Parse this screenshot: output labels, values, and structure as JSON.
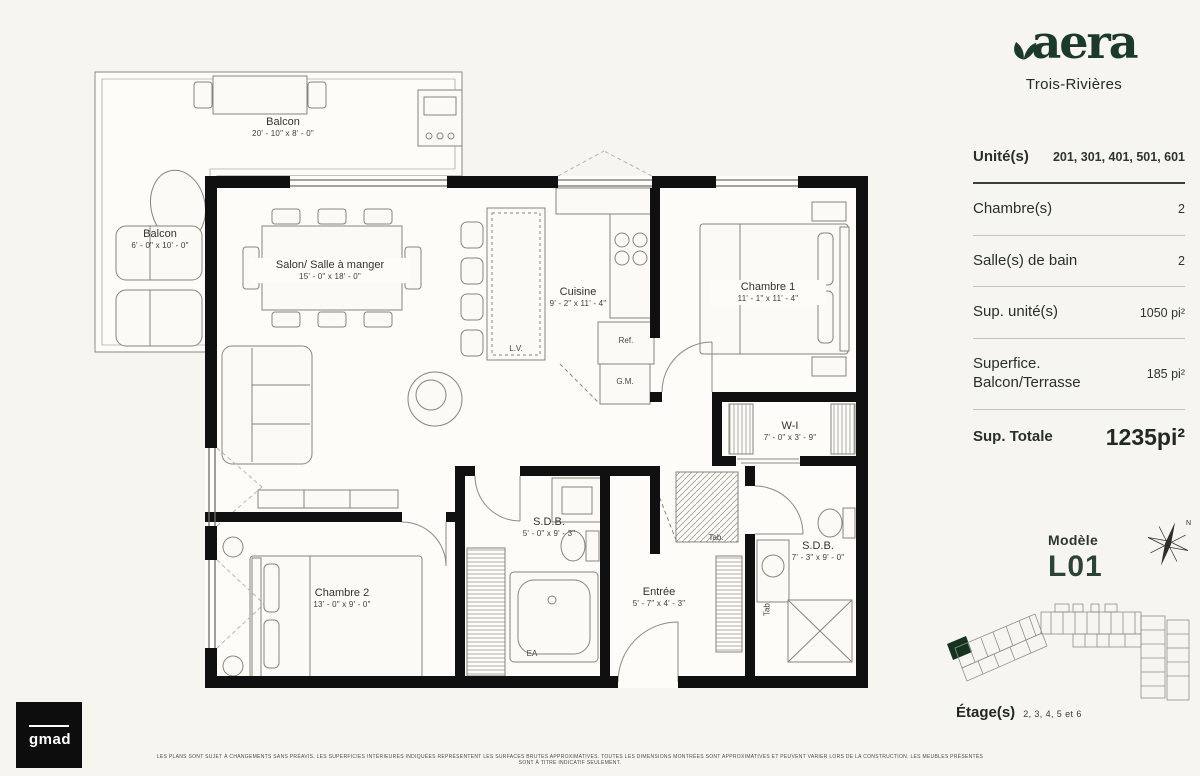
{
  "brand": {
    "name": "aera",
    "location": "Trois-Rivières"
  },
  "sidebar": {
    "unit": {
      "label": "Unité(s)",
      "value": "201, 301, 401, 501, 601"
    },
    "specs": [
      {
        "label": "Chambre(s)",
        "value": "2"
      },
      {
        "label": "Salle(s) de bain",
        "value": "2"
      },
      {
        "label": "Sup. unité(s)",
        "value": "1050 pi²"
      },
      {
        "label": "Superfice. Balcon/Terrasse",
        "value": "185 pi²"
      }
    ],
    "total": {
      "label": "Sup. Totale",
      "value": "1235pi²"
    },
    "model": {
      "caption": "Modèle",
      "name": "L01"
    },
    "compass": {
      "north": "N"
    },
    "floors": {
      "label": "Étage(s)",
      "value": "2, 3, 4, 5 et 6"
    }
  },
  "plan": {
    "rooms": {
      "balcon_top": {
        "name": "Balcon",
        "dims": "20' - 10\" x 8' - 0\""
      },
      "balcon_left": {
        "name": "Balcon",
        "dims": "6' - 0\" x 10' - 0\""
      },
      "salon": {
        "name": "Salon/ Salle à manger",
        "dims": "15' - 0\" x 18' - 0\""
      },
      "cuisine": {
        "name": "Cuisine",
        "dims": "9' - 2\" x 11' - 4\""
      },
      "chambre1": {
        "name": "Chambre 1",
        "dims": "11' - 1\" x 11' - 4\""
      },
      "walkin": {
        "name": "W-I",
        "dims": "7' - 0\" x 3' - 9\""
      },
      "sdb1": {
        "name": "S.D.B.",
        "dims": "5' - 0\" x 9' - 3\""
      },
      "sdb2": {
        "name": "S.D.B.",
        "dims": "7' - 3\" x 9' - 0\""
      },
      "entree": {
        "name": "Entrée",
        "dims": "5' - 7\" x 4' - 3\""
      },
      "chambre2": {
        "name": "Chambre 2",
        "dims": "13' - 0\" x 9' - 0\""
      }
    },
    "fixtures": {
      "lv": "L.V.",
      "ref": "Ref.",
      "gm": "G.M.",
      "tab1": "Tab.",
      "tab2": "Tab.",
      "ea": "EA"
    }
  },
  "footer": {
    "maker": "gmad",
    "disclaimer": "LES PLANS SONT SUJET À CHANGEMENTS SANS PRÉAVIS. LES SUPERFICIES INTÉRIEURES INDIQUÉES REPRÉSENTENT LES SURFACES BRUTES APPROXIMATIVES. TOUTES LES DIMENSIONS MONTRÉES SONT APPROXIMATIVES ET PEUVENT VARIER LORS DE LA CONSTRUCTION. LES MEUBLES PRÉSENTÉS SONT À TITRE INDICATIF SEULEMENT."
  },
  "colors": {
    "accent_green": "#1b3a2a",
    "wall_black": "#101010",
    "background": "#f7f5ef"
  }
}
